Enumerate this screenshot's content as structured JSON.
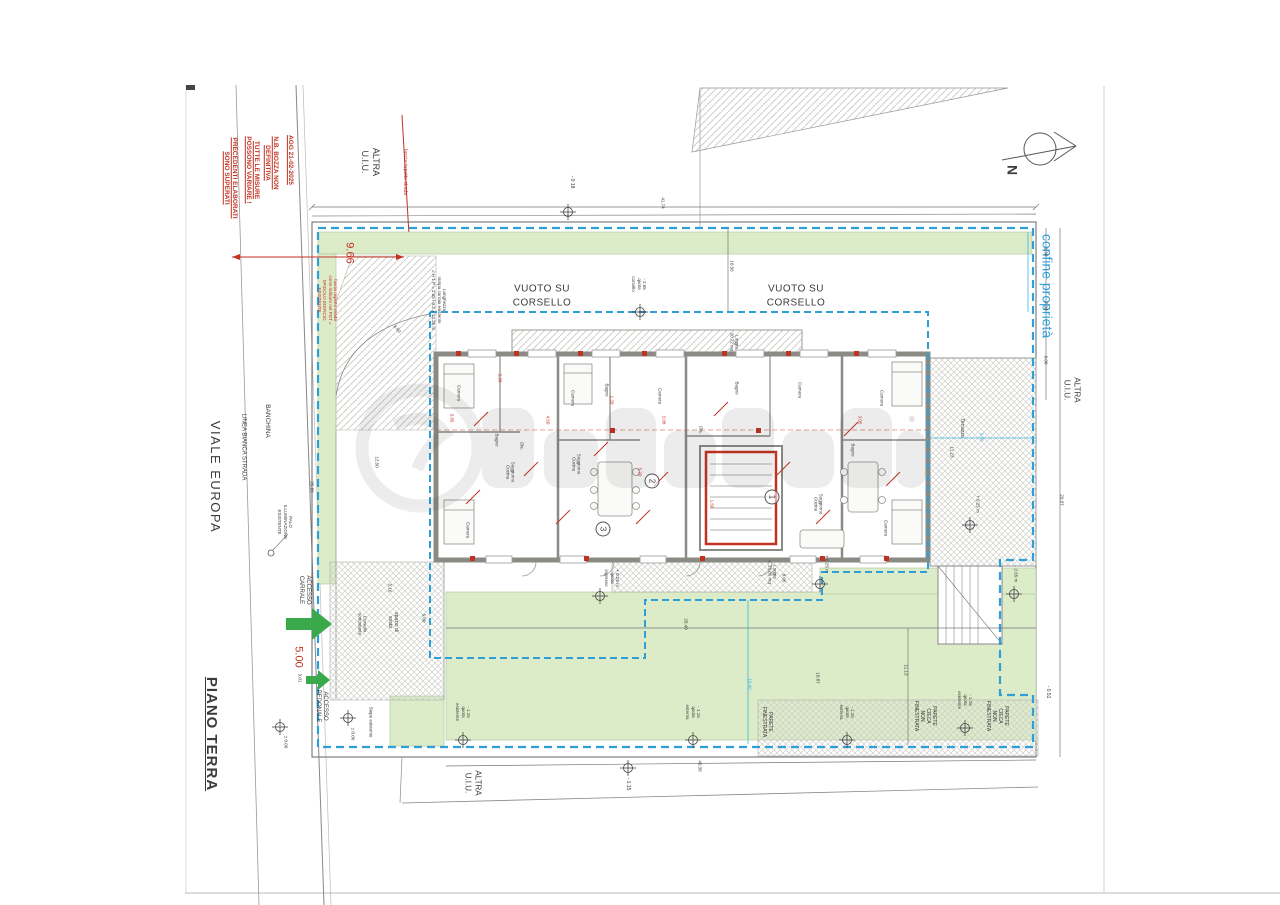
{
  "page": {
    "title": "PIANO TERRA"
  },
  "street": {
    "name": "VIALE EUROPA",
    "linea_bianca": "LINEA BIANCA STRADA",
    "banchina": "BANCHINA",
    "palo": "PALO\nILLUMINAZIONE\nESISTENTE"
  },
  "revision": {
    "l1": "AGG 21-02-2025",
    "l2": "N.B. BOZZA NON\nDEFINITIVA",
    "l3": "TUTTE LE MISURE\nPOSSONO VARIARE !",
    "l4": "PRECEDENTI ELABORATI\nSONO SUPERATI"
  },
  "compass": {
    "label": "N"
  },
  "boundary": {
    "confine": "confine proprietà"
  },
  "neighbors": {
    "top": "ALTRA\nU.I.U.",
    "right": "ALTRA\nU.I.U.",
    "bottom": "ALTRA\nU.I.U."
  },
  "fascia": {
    "line_label": "fascia rispetto strada",
    "dim": "9.66",
    "note": "fascia rispetto strada\ncome indicato nel PGT =\nSPIGOLO EDIFICIO\nESISTENTE",
    "ramp": "Lunghezza\nrampa carraia esistente\n= H 1 P = 2.65 / 0.2 = 13.25 m",
    "arc": "4.50"
  },
  "corsello": {
    "void_left": "VUOTO SU\nCORSELLO",
    "void_right": "VUOTO SU\nCORSELLO",
    "quota": "- 2.65\nquota\ncorsello"
  },
  "access": {
    "carrale": "ACCESSO\nCARRALE",
    "pedonale": "ACCESSO\nPEDONALE",
    "larghezza": "5.00",
    "larghezza_sub": "3.01",
    "spazio": "spazio di\nsosta",
    "corsello_note": "Corsello\nsottostante",
    "siepe": "Siepe esistente"
  },
  "quote": {
    "m018": "- 0.18",
    "zero": "± 0.00",
    "zero2": "± 0.00",
    "m115": "- 1.15",
    "m115_esterna": "- 1.15\nquota\nesterna",
    "m115_esterna2": "- 1.15\nquota\nesterna",
    "m115_esistente": "- 1.15\nquota\nesistente",
    "m115_esistente2": "- 1.15\nquota\nesistente",
    "p025_ingresso": "+ 0.25 m\nquota\ningresso",
    "p025_loggia": "+ 0.25 m",
    "p025_terrazzo": "+ 0.25 m",
    "m265": "- 2.65 m",
    "m051": "- 0.51"
  },
  "walls_labels": {
    "finestrata": "PARETE\nFINESTRATA",
    "cieca1": "PARETE\nCIECA\nNON\nFINESTRATA",
    "cieca2": "PARETE\nCIECA\nNON\nFINESTRATA"
  },
  "areas": {
    "terrazzo": "Terrazzo",
    "loggia_top": "Loggia\n20.72 mq",
    "loggia_bottom": "Loggia\ns. 13.86 mq"
  },
  "units": {
    "u1": "1",
    "u2": "2",
    "u3": "3"
  },
  "rooms": [
    "Camera",
    "Bagno",
    "Dis.",
    "Soggiorno\nCucina",
    "Camera",
    "Camera",
    "Bagno",
    "Soggiorno\nCucina",
    "Camera",
    "Dis.",
    "Bagno",
    "Camera",
    "Soggiorno\nCucina",
    "Bagno",
    "Camera",
    "Camera"
  ],
  "plan_dims": [
    "3.85",
    "2.30",
    "4.50",
    "1.20",
    "3.08",
    "5.70",
    "3.05",
    "1.50"
  ],
  "dims": {
    "top": "41.74",
    "h1056": "10.56",
    "left1250": "12.50",
    "street2588": "25.88",
    "r190": "1.90",
    "r798": "7.98",
    "r600": "6.00",
    "r2907": "29.07",
    "t1123": "11.23",
    "t390": "3.90",
    "bottom2840": "28.40",
    "b1000": "10.00",
    "b1087": "10.87",
    "b1113": "11.13",
    "b4038": "40.38",
    "a516": "5.16",
    "a500": "5.00",
    "l805": "8.05"
  },
  "watermark": {
    "reg": "®"
  }
}
